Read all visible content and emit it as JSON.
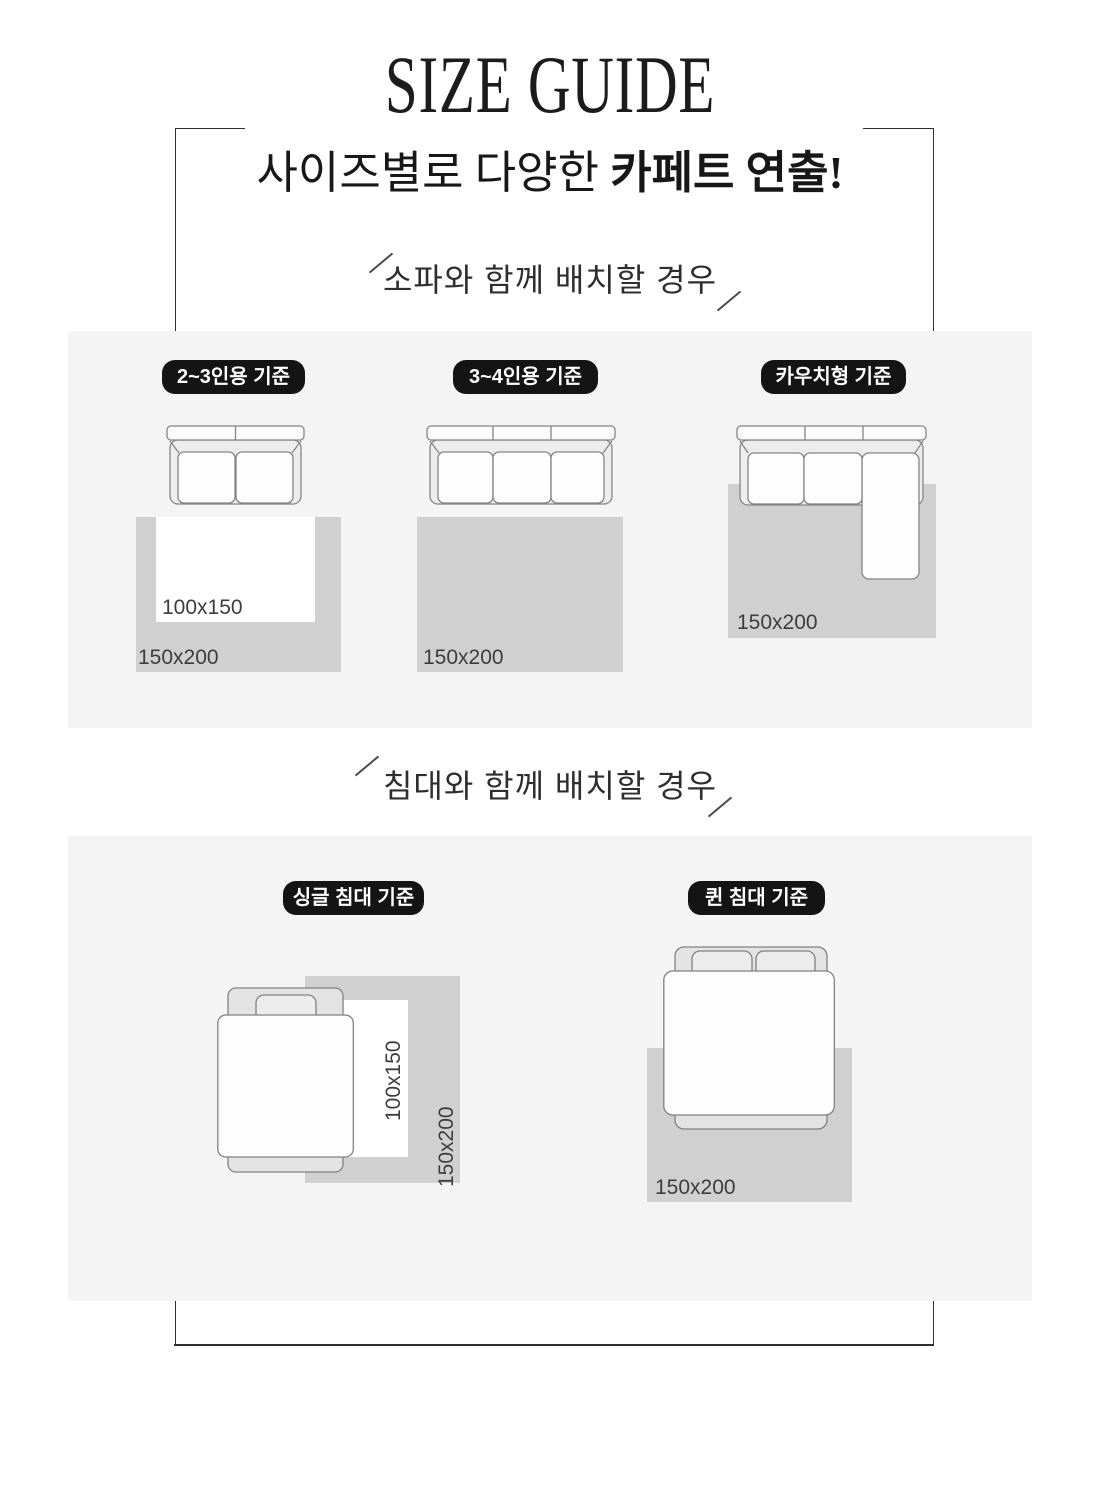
{
  "header": {
    "title": "SIZE GUIDE",
    "subtitle_regular": "사이즈별로 다양한 ",
    "subtitle_bold": "카페트 연출!"
  },
  "sofa_section": {
    "heading": "소파와 함께 배치할 경우",
    "columns": [
      {
        "badge": "2~3인용 기준",
        "furniture": "sofa-2-seat",
        "rug_small_label": "100x150",
        "rug_large_label": "150x200"
      },
      {
        "badge": "3~4인용 기준",
        "furniture": "sofa-3-seat",
        "rug_large_label": "150x200"
      },
      {
        "badge": "카우치형 기준",
        "furniture": "sofa-couch-l-shape",
        "rug_large_label": "150x200"
      }
    ]
  },
  "bed_section": {
    "heading": "침대와 함께 배치할 경우",
    "columns": [
      {
        "badge": "싱글 침대 기준",
        "furniture": "bed-single",
        "rug_small_label": "100x150",
        "rug_large_label": "150x200"
      },
      {
        "badge": "퀸 침대 기준",
        "furniture": "bed-queen",
        "rug_large_label": "150x200"
      }
    ]
  },
  "colors": {
    "page_bg": "#ffffff",
    "panel_bg": "#f4f4f5",
    "rug_gray": "#d0d0d0",
    "rug_white": "#ffffff",
    "badge_bg": "#141414",
    "badge_text": "#ffffff",
    "frame_line": "#2f2f2f",
    "furniture_outline": "#858585",
    "size_label_text": "#3d3d3d"
  }
}
